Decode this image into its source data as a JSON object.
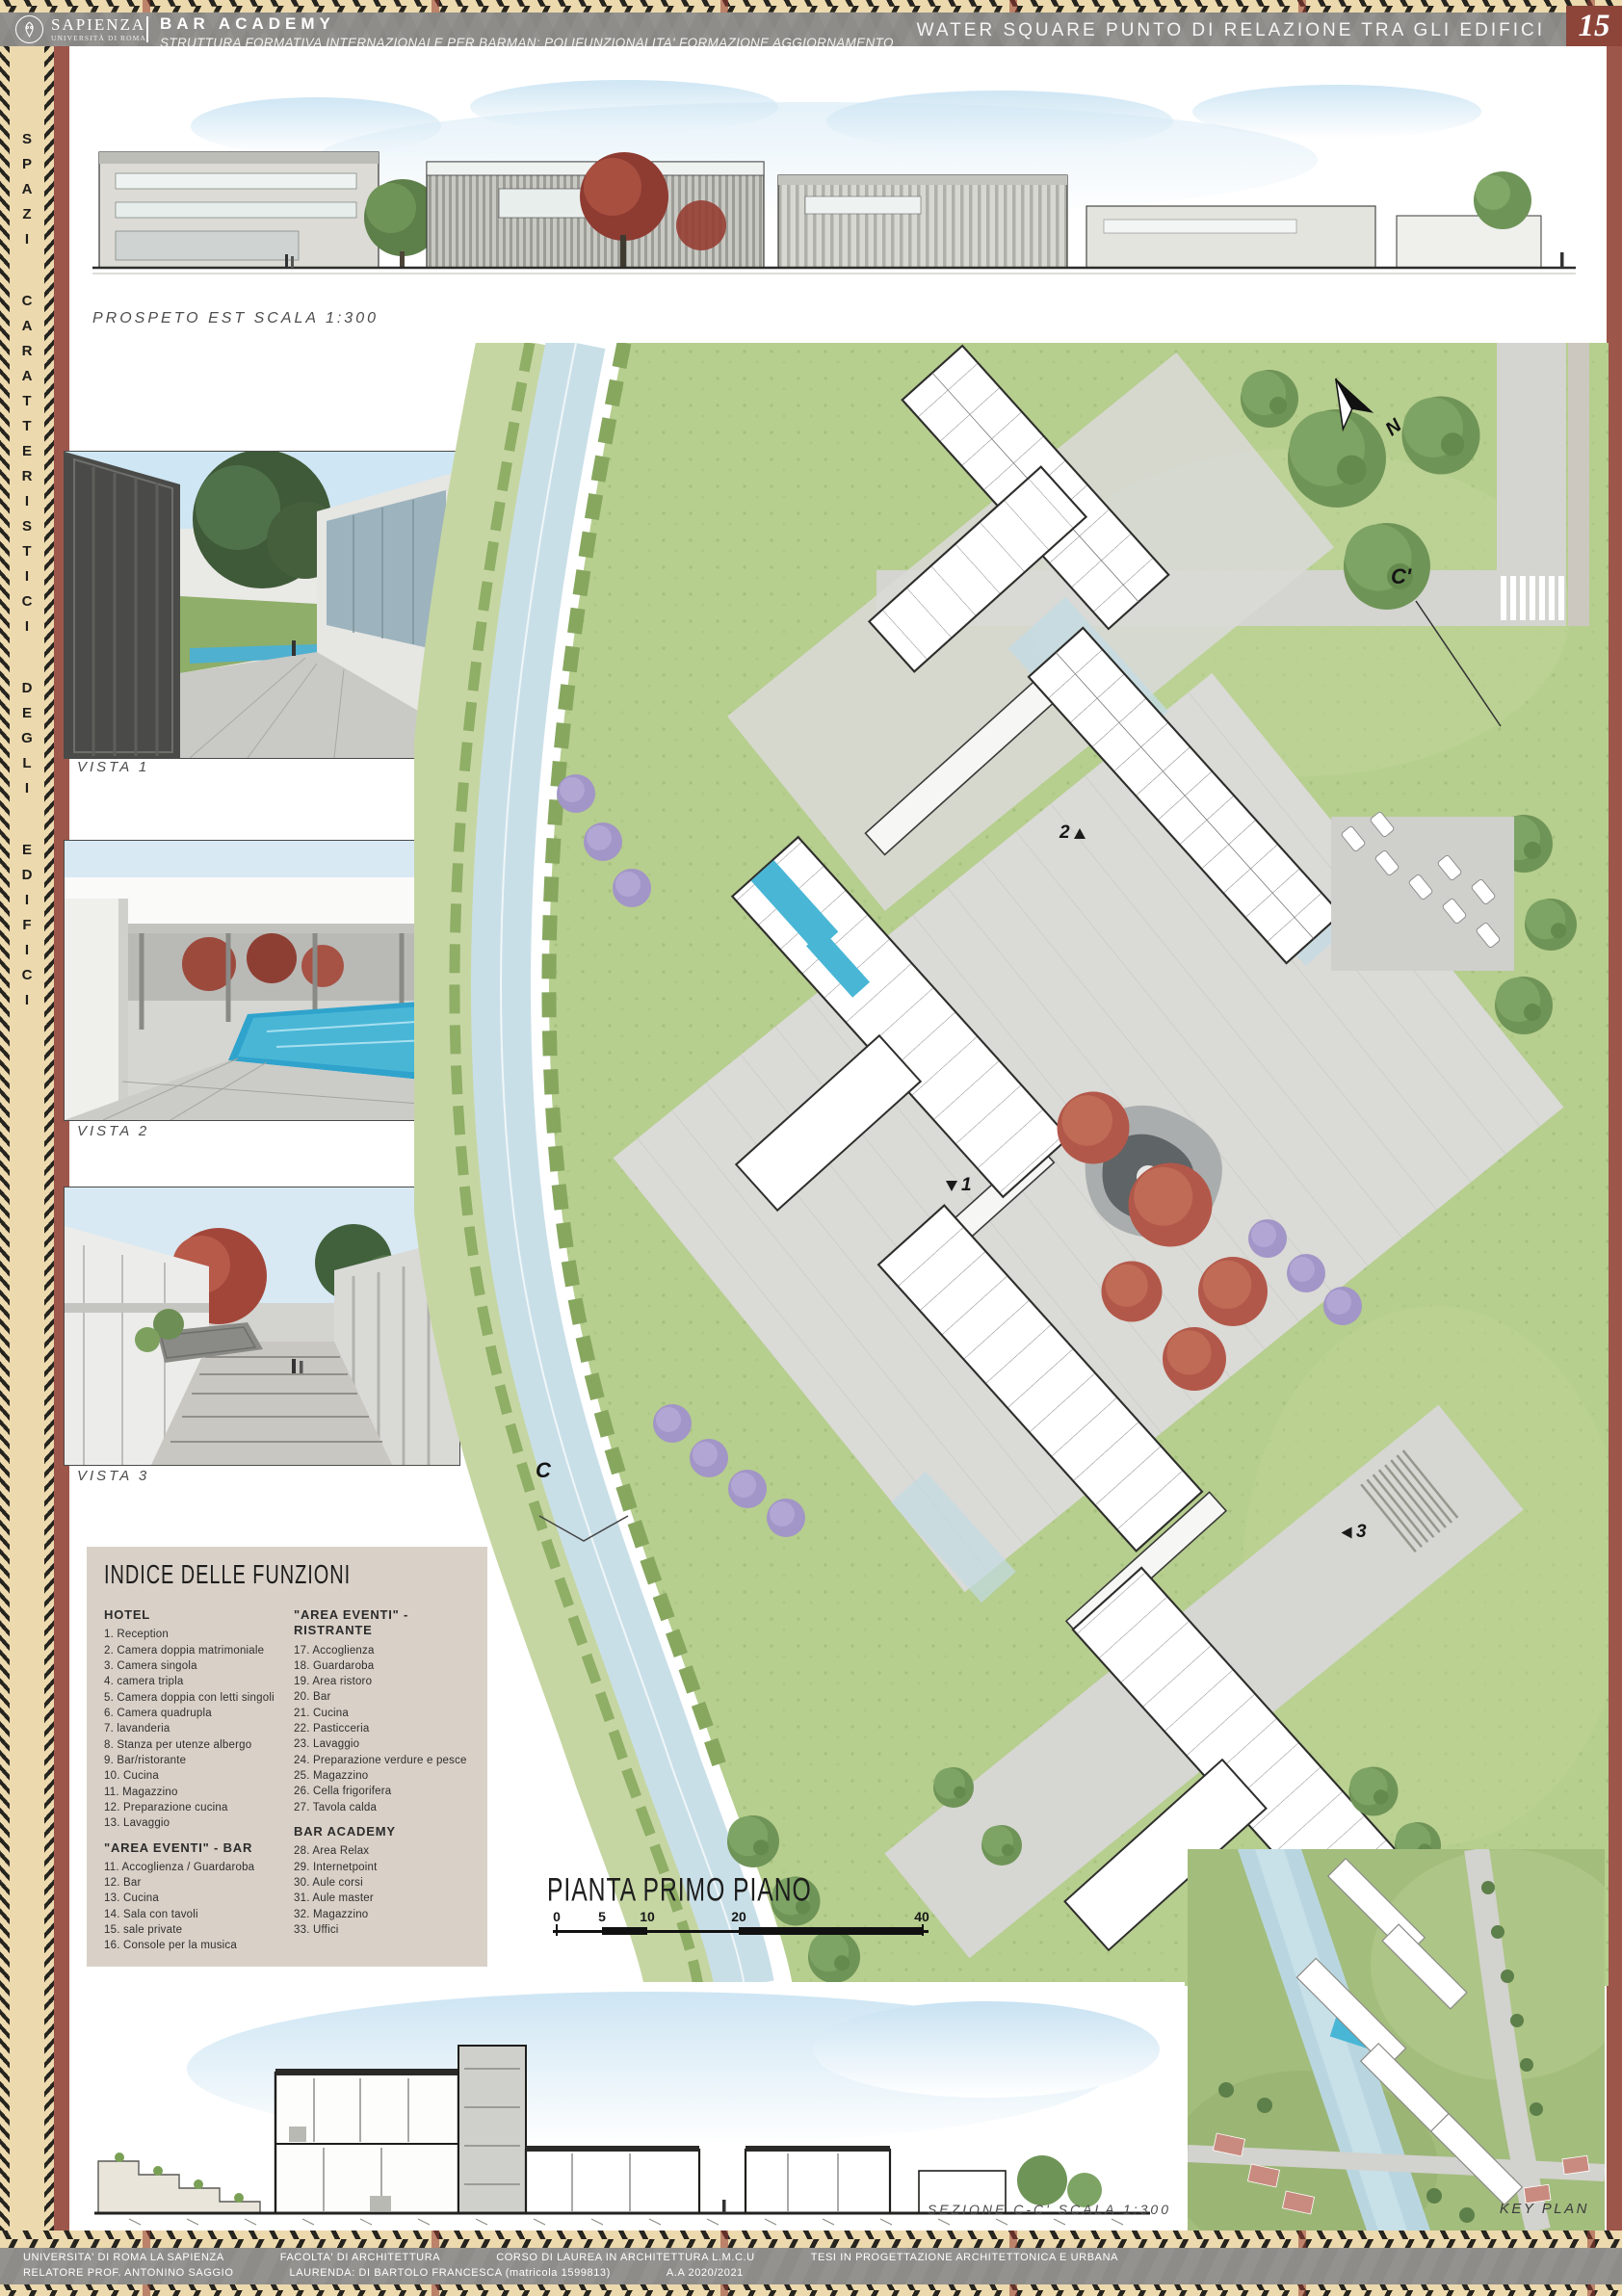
{
  "colors": {
    "maroon": "#9d564a",
    "tan": "#ecd9ae",
    "header_gray": "#8e8c89",
    "index_bg": "#d9d0c7",
    "accent_black": "#26241f"
  },
  "header": {
    "logo_title": "SAPIENZA",
    "logo_subtitle": "UNIVERSITÀ DI ROMA",
    "title": "BAR ACADEMY",
    "subtitle": "STRUTTURA FORMATIVA INTERNAZIONALE PER BARMAN: POLIFUNZIONALITA' FORMAZIONE AGGIORNAMENTO",
    "right_title": "WATER SQUARE PUNTO DI RELAZIONE TRA GLI EDIFICI",
    "page_number": "15"
  },
  "sidebar": {
    "vertical_text": "SPAZI CARATTERISTICI DEGLI EDIFICI"
  },
  "elevation": {
    "label": "PROSPETO EST SCALA 1:300"
  },
  "vistas": [
    {
      "label": "VISTA 1"
    },
    {
      "label": "VISTA 2"
    },
    {
      "label": "VISTA 3"
    }
  ],
  "index_box": {
    "title": "INDICE DELLE FUNZIONI",
    "col1": [
      {
        "heading": "HOTEL",
        "items": [
          "1. Reception",
          "2. Camera doppia matrimoniale",
          "3. Camera singola",
          "4. camera tripla",
          "5. Camera doppia con letti singoli",
          "6. Camera quadrupla",
          "7. lavanderia",
          "8. Stanza per utenze albergo",
          "9. Bar/ristorante",
          "10. Cucina",
          "11. Magazzino",
          "12. Preparazione cucina",
          "13. Lavaggio"
        ]
      },
      {
        "heading": "\"AREA EVENTI\" - BAR",
        "items": [
          "11. Accoglienza / Guardaroba",
          "12. Bar",
          "13. Cucina",
          "14. Sala con tavoli",
          "15. sale private",
          "16. Console per la musica"
        ]
      }
    ],
    "col2": [
      {
        "heading": "\"AREA EVENTI\" - RISTRANTE",
        "items": [
          "17. Accoglienza",
          "18. Guardaroba",
          "19. Area ristoro",
          "20. Bar",
          "21. Cucina",
          "22. Pasticceria",
          "23. Lavaggio",
          "24. Preparazione verdure e pesce",
          "25. Magazzino",
          "26. Cella frigorifera",
          "27. Tavola calda"
        ]
      },
      {
        "heading": "BAR ACADEMY",
        "items": [
          "28. Area Relax",
          "29. Internetpoint",
          "30. Aule corsi",
          "31. Aule master",
          "32. Magazzino",
          "33. Uffici"
        ]
      }
    ]
  },
  "plan": {
    "title": "PIANTA PRIMO PIANO",
    "scale_ticks": [
      "0",
      "5",
      "10",
      "20",
      "40"
    ],
    "north_label": "N",
    "marker_c_prime": "C'",
    "marker_c": "C",
    "view_markers": [
      "1",
      "2",
      "3"
    ]
  },
  "section": {
    "label": "SEZIONE C-C' SCALA 1:300"
  },
  "keyplan": {
    "label": "KEY PLAN"
  },
  "footer": {
    "line1": [
      "UNIVERSITA' DI ROMA LA SAPIENZA",
      "FACOLTA' DI ARCHITETTURA",
      "CORSO DI LAUREA IN ARCHITETTURA L.M.C.U",
      "TESI IN PROGETTAZIONE ARCHITETTONICA E URBANA"
    ],
    "line2": [
      "RELATORE PROF. ANTONINO SAGGIO",
      "LAURENDA: DI BARTOLO FRANCESCA (matricola 1599813)",
      "A.A 2020/2021"
    ]
  }
}
